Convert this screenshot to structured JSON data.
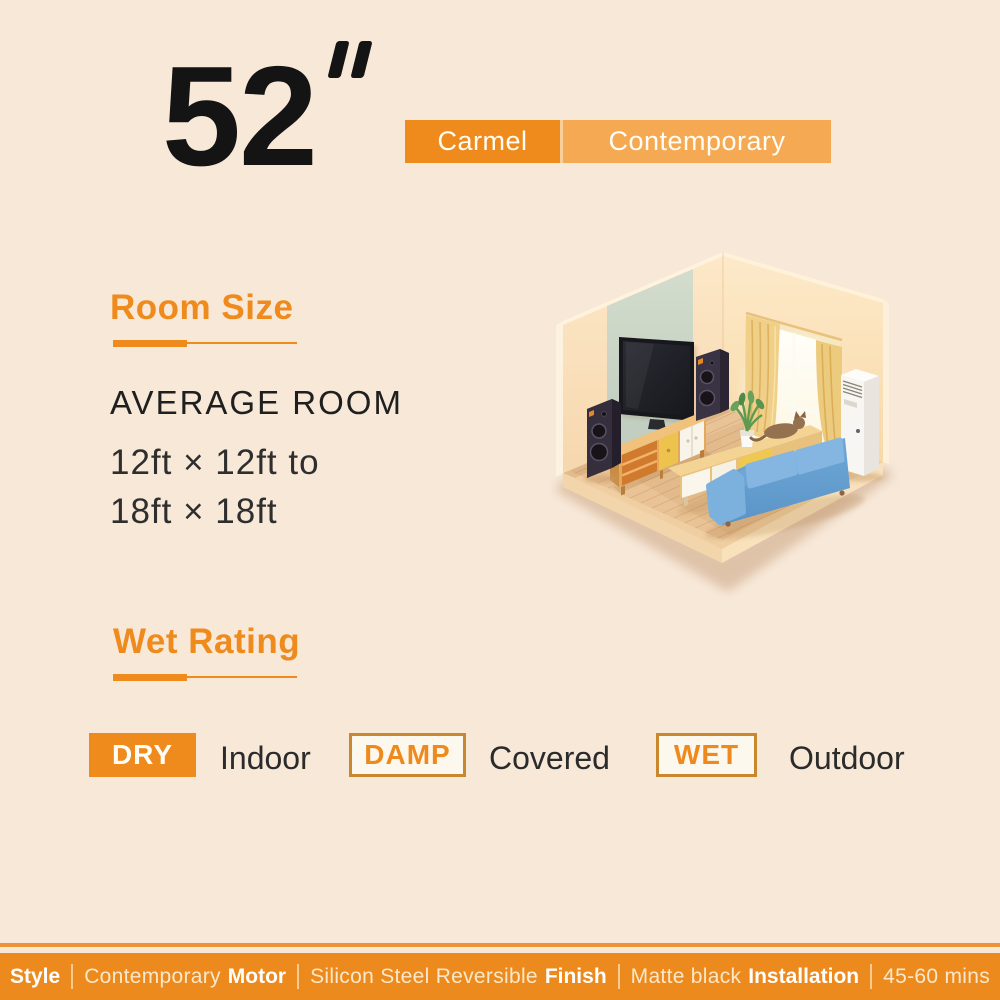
{
  "page": {
    "background": "#f7e8d8"
  },
  "header": {
    "size_value": "52",
    "size_unit": "inch",
    "series_name": "Carmel",
    "style_name": "Contemporary",
    "series_bg": "#ef8a1d",
    "style_bg": "#f4a952"
  },
  "room_size": {
    "heading": "Room Size",
    "subheading": "AVERAGE ROOM",
    "dimensions_line1": "12ft × 12ft to",
    "dimensions_line2": "18ft × 18ft"
  },
  "wet_rating": {
    "heading": "Wet Rating",
    "ratings": [
      {
        "badge": "DRY",
        "label": "Indoor",
        "style": "filled"
      },
      {
        "badge": "DAMP",
        "label": "Covered",
        "style": "outlined"
      },
      {
        "badge": "WET",
        "label": "Outdoor",
        "style": "outlined"
      }
    ]
  },
  "illustration": {
    "description": "Isometric living room: wall TV on sage panel, two tower speakers, wood media console, golden curtains with bright window, white floor air conditioner, long wood table with plant and cat, blue two-seat sofa, plank wood floor"
  },
  "footer": {
    "specs": [
      {
        "label": "Style",
        "value": "Contemporary"
      },
      {
        "label": "Motor",
        "value": "Silicon Steel Reversible"
      },
      {
        "label": "Finish",
        "value": "Matte black"
      },
      {
        "label": "Installation",
        "value": "45-60 mins"
      }
    ]
  },
  "colors": {
    "accent": "#ef8a1d",
    "accent_light": "#f4a952",
    "badge_border": "#c9882e",
    "footer_bar": "#ec8a1e",
    "text_dark": "#1f1f1f",
    "sofa_blue": "#6ca9da"
  }
}
